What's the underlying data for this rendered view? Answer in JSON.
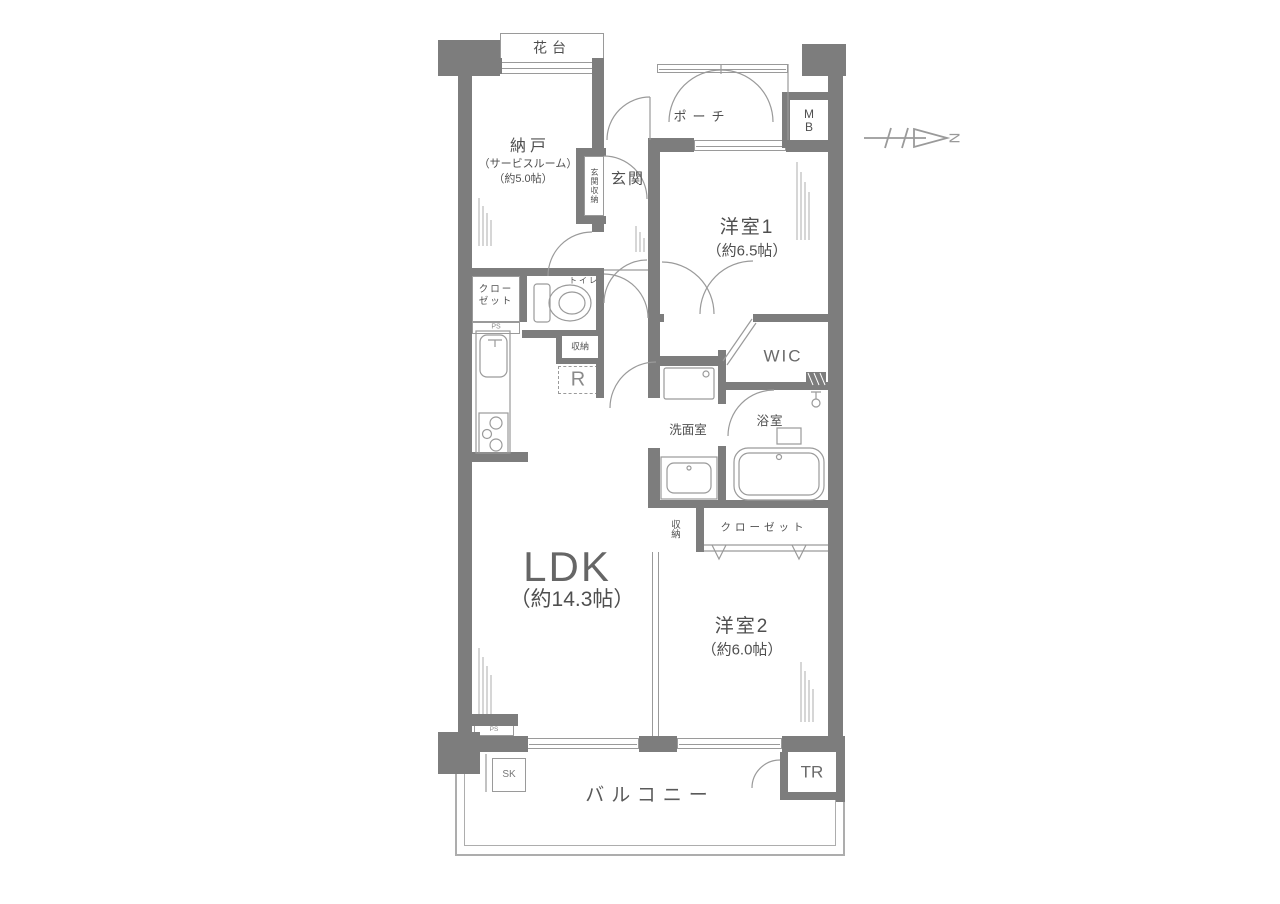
{
  "rooms": {
    "hanadai": "花台",
    "porch": "ポーチ",
    "mb": "M\nB",
    "nando": "納戸",
    "nando_sub1": "（サービスルーム）",
    "nando_sub2": "（約5.0帖）",
    "genkan_storage": "玄関収納",
    "genkan": "玄関",
    "yoshitsu1": "洋室1",
    "yoshitsu1_size": "（約6.5帖）",
    "closet_upper": "クロー\nゼット",
    "ps_upper": "PS",
    "toilet": "トイレ",
    "storage_mid": "収納",
    "fridge": "R",
    "wic": "WIC",
    "senmen": "洗面室",
    "yokushitsu": "浴室",
    "ldk": "LDK",
    "ldk_size": "（約14.3帖）",
    "storage_lower": "収納",
    "closet_lower": "クローゼット",
    "yoshitsu2": "洋室2",
    "yoshitsu2_size": "（約6.0帖）",
    "sk": "SK",
    "balcony": "バルコニー",
    "tr": "TR",
    "ps_lower": "PS",
    "compass_north": "N"
  },
  "colors": {
    "wall": "#7d7d7d",
    "line": "#9a9a9a",
    "text": "#4f4f4f",
    "background": "#ffffff"
  }
}
